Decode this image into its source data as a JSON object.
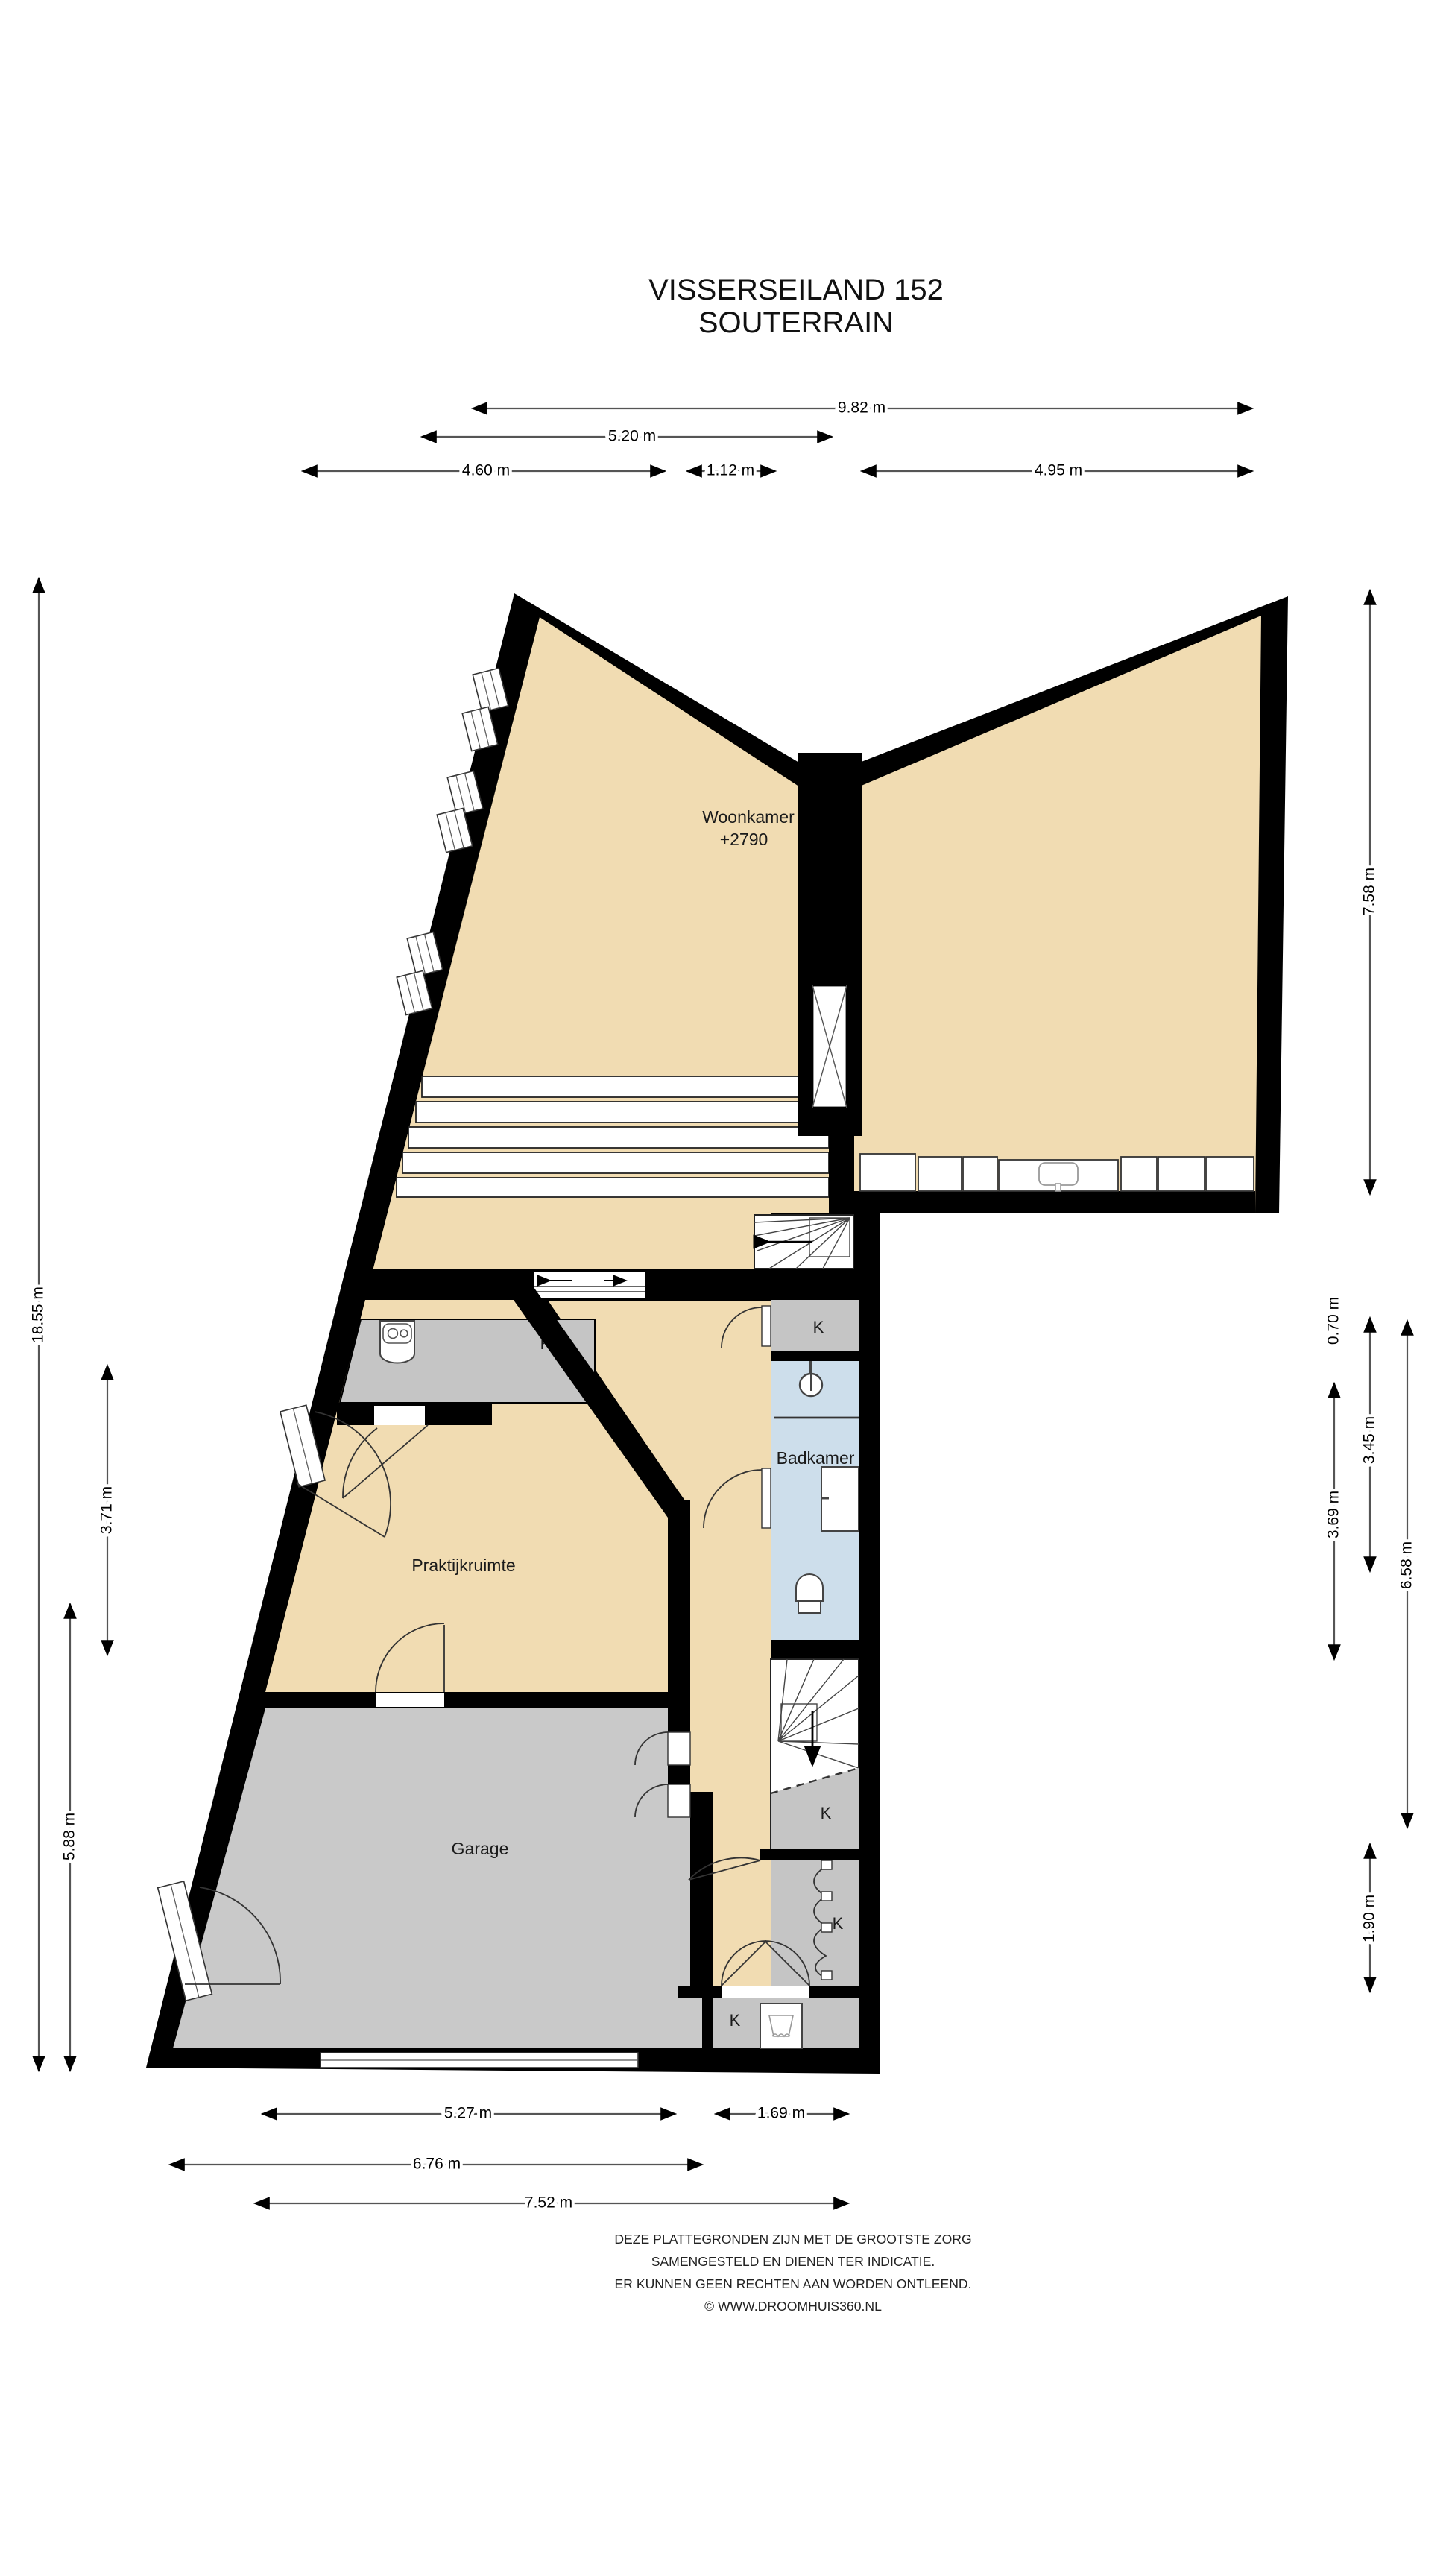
{
  "title": {
    "line1": "VISSERSEILAND 152",
    "line2": "SOUTERRAIN"
  },
  "rooms": {
    "woonkamer": {
      "label": "Woonkamer",
      "level": "+2790"
    },
    "praktijkruimte": {
      "label": "Praktijkruimte"
    },
    "badkamer": {
      "label": "Badkamer"
    },
    "garage": {
      "label": "Garage"
    },
    "closet": {
      "label": "K"
    }
  },
  "dimensions": {
    "top": [
      "9.82 m",
      "5.20 m",
      "4.60 m",
      "1.12 m",
      "4.95 m"
    ],
    "left": [
      "18.55 m",
      "3.71 m",
      "5.88 m"
    ],
    "right": [
      "7.58 m",
      "0.70 m",
      "3.45 m",
      "3.69 m",
      "6.58 m",
      "1.90 m"
    ],
    "bottom": [
      "5.27 m",
      "1.69 m",
      "6.76 m",
      "7.52 m"
    ]
  },
  "footer": [
    "DEZE PLATTEGRONDEN ZIJN MET DE GROOTSTE ZORG",
    "SAMENGESTELD EN DIENEN TER INDICATIE.",
    "ER KUNNEN GEEN RECHTEN AAN WORDEN ONTLEEND.",
    "© WWW.DROOMHUIS360.NL"
  ],
  "colors": {
    "wall": "#000000",
    "floor_living": "#F1DCB2",
    "floor_garage": "#C9C9C9",
    "floor_closet": "#C5C5C5",
    "floor_bath": "#CDDEEB",
    "dimension_line": "#555555"
  }
}
